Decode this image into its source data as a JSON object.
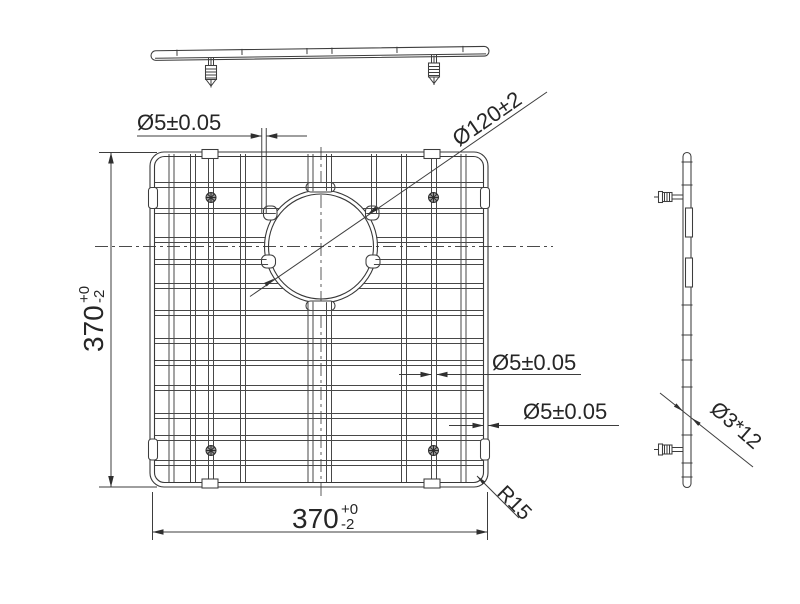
{
  "annotations": {
    "wire_top": "Ø5±0.05",
    "hole": "Ø120±2",
    "wire_mid": "Ø5±0.05",
    "wire_frame": "Ø5±0.05",
    "corner_radius": "R15",
    "foot_screw": "Ø3*12",
    "width": {
      "value": "370",
      "tol_top": "+0",
      "tol_bottom": "-2"
    },
    "height": {
      "value": "370",
      "tol_top": "+0",
      "tol_bottom": "-2"
    }
  },
  "colors": {
    "line": "#3d3d3d",
    "text": "#262626",
    "background": "#ffffff"
  }
}
